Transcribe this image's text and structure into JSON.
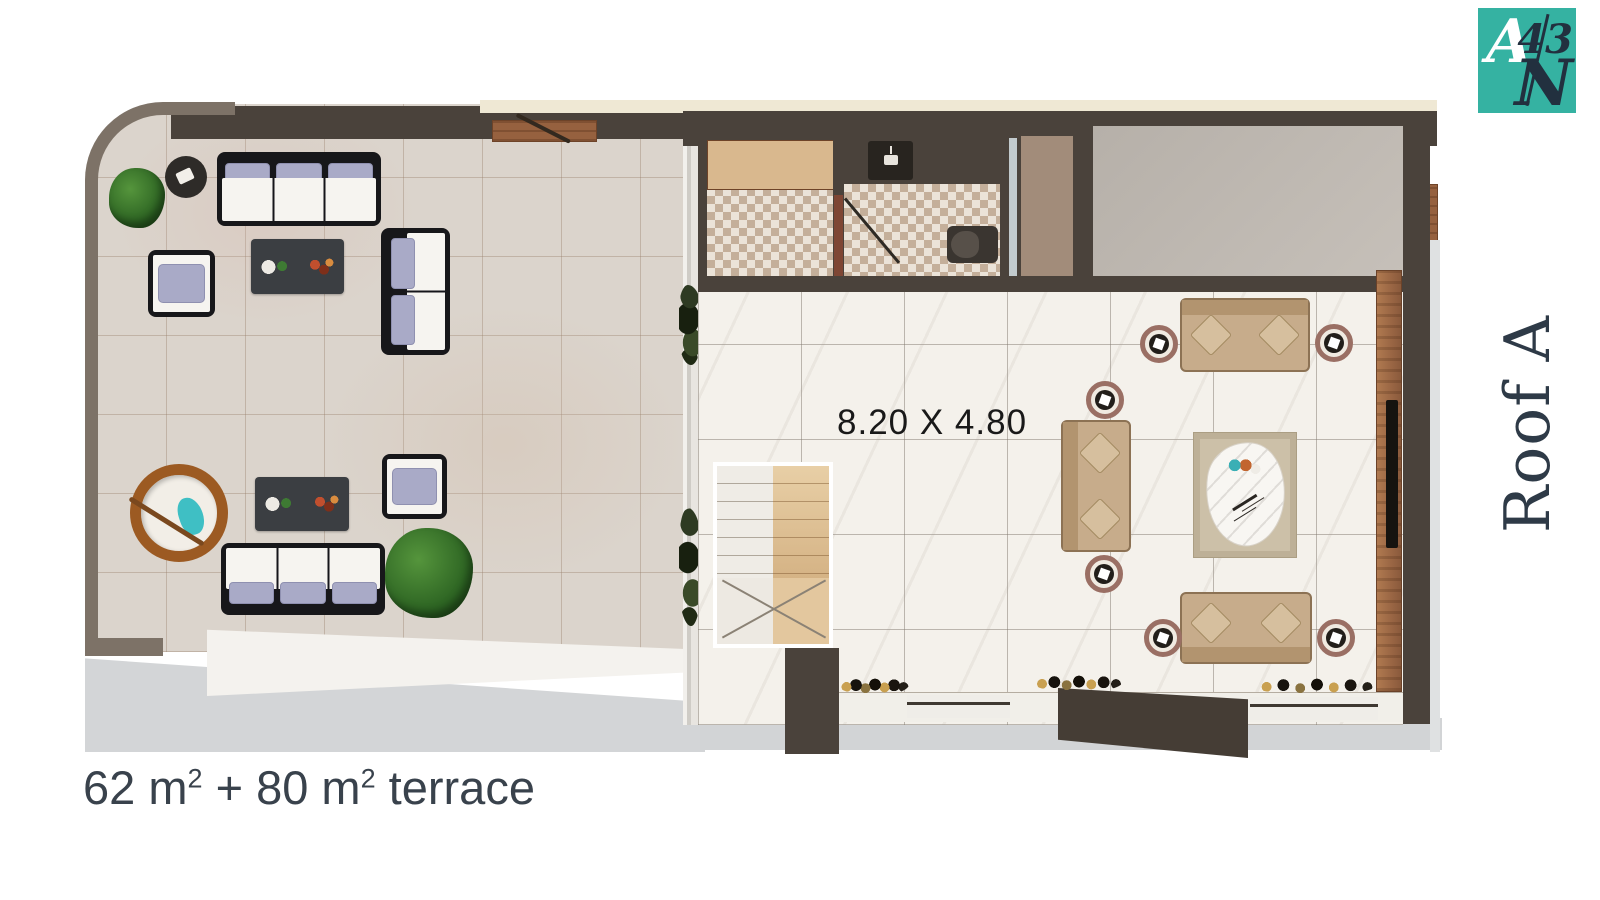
{
  "logo": {
    "letter_top": "A",
    "number": "43",
    "letter_bottom": "N"
  },
  "labels": {
    "roof_name": "Roof A",
    "dimension": "8.20 X 4.80",
    "area_value_1": "62 m",
    "area_sup_1": "2",
    "area_value_2": " + 80 m",
    "area_sup_2": "2",
    "area_suffix": " terrace"
  },
  "colors": {
    "teal": "#35b2a2",
    "navy": "#22303f",
    "ink": "#2e3a47",
    "wall": "#4a423b",
    "wall_light": "#7d7267",
    "wood": "#96613f",
    "terrace_tile": "#dbd4cc",
    "marble": "#f4f1eb",
    "cream": "#efe8d4",
    "gray_room": "#bcb6af",
    "mosaic": "#ebe3d8",
    "tan_panel": "#a28c7a",
    "sofa_beige": "#c7ac8b",
    "pillow_beige": "#d6bf9e",
    "lavender": "#a9aac7",
    "frame_black": "#17171a",
    "table_dark": "#3b3e42",
    "ring_mauve": "#9a6f64",
    "rug": "#ccc0a8",
    "egg_rattan": "#9c5a22",
    "egg_teal": "#3fbfc4",
    "glass": "#c2cacd",
    "toilet": "#3a3530",
    "door_red": "#7e4634",
    "ledge_white": "#f4f2ee",
    "exterior": "#d2d4d6"
  }
}
